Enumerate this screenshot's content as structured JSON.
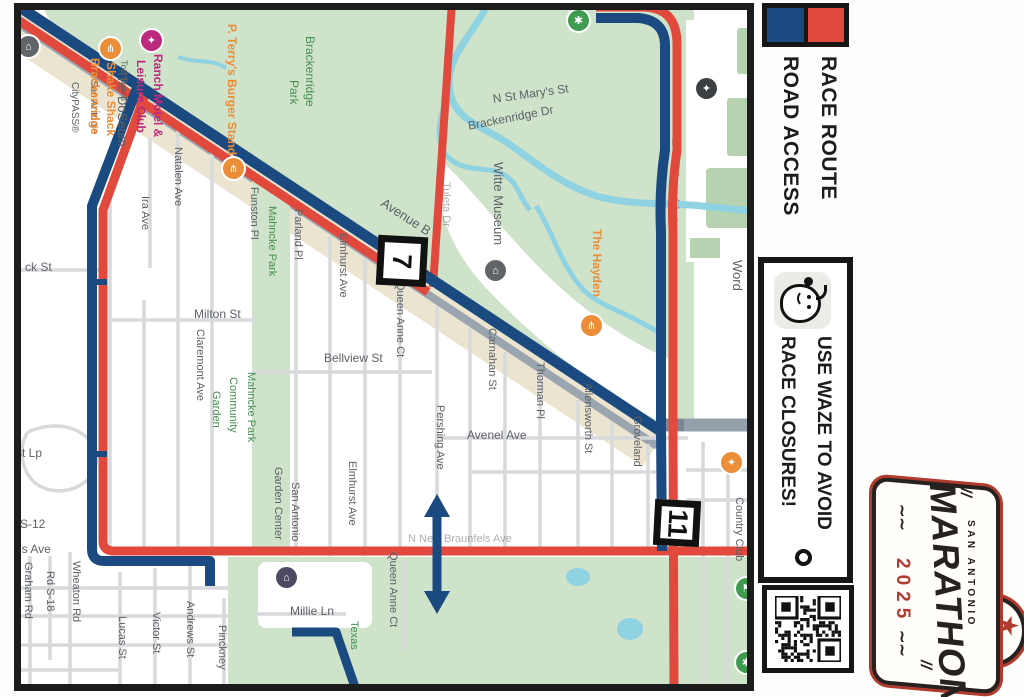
{
  "legend": {
    "race_route_label": "RACE ROUTE",
    "road_access_label": "ROAD ACCESS",
    "route_color": "#1b4a80",
    "access_color": "#e1493d"
  },
  "waze": {
    "line1": "USE WAZE TO AVOID",
    "line2": "RACE CLOSURES!"
  },
  "logo": {
    "city": "SAN ANTONIO",
    "title": "MARATHON",
    "year": "2025"
  },
  "map": {
    "mile_markers": [
      {
        "label": "7",
        "x": 377,
        "y": 236,
        "size": 50
      },
      {
        "label": "11",
        "x": 654,
        "y": 500,
        "size": 46
      }
    ],
    "labels": [
      {
        "text": "The DoSeum",
        "x": 113,
        "y": 70,
        "o": "v",
        "c": "gray",
        "s": 13
      },
      {
        "text": "San Antonio",
        "x": 85,
        "y": 80,
        "o": "v",
        "c": "gray",
        "s": 10
      },
      {
        "text": "CityPASS®",
        "x": 66,
        "y": 82,
        "o": "v",
        "c": "gray",
        "s": 10
      },
      {
        "text": "Ranch Motel &",
        "x": 149,
        "y": 54,
        "o": "v",
        "c": "pink",
        "s": 12
      },
      {
        "text": "Leisure Club",
        "x": 132,
        "y": 60,
        "o": "v",
        "c": "pink",
        "s": 12
      },
      {
        "text": "Top Rated",
        "x": 116,
        "y": 60,
        "o": "v",
        "c": "gray",
        "s": 9
      },
      {
        "text": "Shake Shack",
        "x": 102,
        "y": 62,
        "o": "v",
        "c": "orange",
        "s": 12
      },
      {
        "text": "Brackenridge",
        "x": 86,
        "y": 58,
        "o": "v",
        "c": "orange",
        "s": 12
      },
      {
        "text": "P. Terry's Burger Stand",
        "x": 223,
        "y": 24,
        "o": "v",
        "c": "orange",
        "s": 12
      },
      {
        "text": "Brackenridge",
        "x": 301,
        "y": 36,
        "o": "v",
        "c": "green",
        "s": 12
      },
      {
        "text": "Park",
        "x": 285,
        "y": 80,
        "o": "v",
        "c": "green",
        "s": 12
      },
      {
        "text": "Natalen Ave",
        "x": 169,
        "y": 147,
        "o": "v",
        "c": "gray",
        "s": 11
      },
      {
        "text": "Ira Ave",
        "x": 136,
        "y": 196,
        "o": "v",
        "c": "gray",
        "s": 11
      },
      {
        "text": "Funston Pl",
        "x": 245,
        "y": 187,
        "o": "v",
        "c": "gray",
        "s": 11
      },
      {
        "text": "Mahncke Park",
        "x": 263,
        "y": 206,
        "o": "v",
        "c": "green",
        "s": 11
      },
      {
        "text": "Parland Pl",
        "x": 289,
        "y": 209,
        "o": "v",
        "c": "gray",
        "s": 11
      },
      {
        "text": "Elmhurst Ave",
        "x": 334,
        "y": 233,
        "o": "v",
        "c": "gray",
        "s": 11
      },
      {
        "text": "Avenue B",
        "x": 386,
        "y": 196,
        "o": "d",
        "c": "gray",
        "s": 13,
        "rot": 33
      },
      {
        "text": "N St Mary's St",
        "x": 492,
        "y": 93,
        "o": "d",
        "c": "gray",
        "s": 12,
        "rot": -8
      },
      {
        "text": "Brackenridge Dr",
        "x": 467,
        "y": 120,
        "o": "d",
        "c": "gray",
        "s": 12,
        "rot": -11
      },
      {
        "text": "Witte Museum",
        "x": 489,
        "y": 162,
        "o": "v",
        "c": "gray",
        "s": 13
      },
      {
        "text": "The Hayden",
        "x": 588,
        "y": 229,
        "o": "v",
        "c": "orange",
        "s": 12
      },
      {
        "text": "the Incarnate",
        "x": 745,
        "y": 213,
        "o": "v",
        "c": "gray",
        "s": 13
      },
      {
        "text": "Word",
        "x": 728,
        "y": 260,
        "o": "v",
        "c": "gray",
        "s": 13
      },
      {
        "text": "Queen Anne Ct",
        "x": 391,
        "y": 282,
        "o": "v",
        "c": "gray",
        "s": 11
      },
      {
        "text": "Carnahan St",
        "x": 483,
        "y": 328,
        "o": "v",
        "c": "gray",
        "s": 11
      },
      {
        "text": "Thorman Pl",
        "x": 531,
        "y": 362,
        "o": "v",
        "c": "gray",
        "s": 11
      },
      {
        "text": "Allensworth St",
        "x": 579,
        "y": 383,
        "o": "v",
        "c": "gray",
        "s": 11
      },
      {
        "text": "Groveland",
        "x": 628,
        "y": 416,
        "o": "v",
        "c": "gray",
        "s": 11
      },
      {
        "text": "Milton St",
        "x": 194,
        "y": 308,
        "o": "h",
        "c": "gray",
        "s": 12
      },
      {
        "text": "Claremont Ave",
        "x": 191,
        "y": 329,
        "o": "v",
        "c": "gray",
        "s": 11
      },
      {
        "text": "Bellview St",
        "x": 324,
        "y": 352,
        "o": "h",
        "c": "gray",
        "s": 12
      },
      {
        "text": "Mahncke Park",
        "x": 242,
        "y": 372,
        "o": "v",
        "c": "green",
        "s": 11
      },
      {
        "text": "Community",
        "x": 224,
        "y": 377,
        "o": "v",
        "c": "green",
        "s": 11
      },
      {
        "text": "Garden",
        "x": 207,
        "y": 391,
        "o": "v",
        "c": "green",
        "s": 11
      },
      {
        "text": "Avenel Ave",
        "x": 467,
        "y": 429,
        "o": "h",
        "c": "gray",
        "s": 12
      },
      {
        "text": "Pershing Ave",
        "x": 431,
        "y": 405,
        "o": "v",
        "c": "gray",
        "s": 11
      },
      {
        "text": "San Antonio",
        "x": 286,
        "y": 482,
        "o": "v",
        "c": "gray",
        "s": 11
      },
      {
        "text": "Garden Center",
        "x": 269,
        "y": 467,
        "o": "v",
        "c": "gray",
        "s": 11
      },
      {
        "text": "San Antonio",
        "x": 747,
        "y": 494,
        "o": "v",
        "c": "gray",
        "s": 11
      },
      {
        "text": "Country Club",
        "x": 730,
        "y": 497,
        "o": "v",
        "c": "gray",
        "s": 11
      },
      {
        "text": "ck St",
        "x": 25,
        "y": 261,
        "o": "h",
        "c": "gray",
        "s": 12
      },
      {
        "text": "st Lp",
        "x": 16,
        "y": 447,
        "o": "h",
        "c": "gray",
        "s": 12
      },
      {
        "text": "d S-12",
        "x": 10,
        "y": 518,
        "o": "h",
        "c": "gray",
        "s": 12
      },
      {
        "text": "fels Ave",
        "x": 9,
        "y": 543,
        "o": "h",
        "c": "gray",
        "s": 12
      },
      {
        "text": "Graham Rd",
        "x": 19,
        "y": 562,
        "o": "v",
        "c": "gray",
        "s": 11
      },
      {
        "text": "Rd S-18",
        "x": 41,
        "y": 571,
        "o": "v",
        "c": "gray",
        "s": 11
      },
      {
        "text": "Wheaton Rd",
        "x": 67,
        "y": 561,
        "o": "v",
        "c": "gray",
        "s": 11
      },
      {
        "text": "Lucas St",
        "x": 113,
        "y": 616,
        "o": "v",
        "c": "gray",
        "s": 11
      },
      {
        "text": "Victor St",
        "x": 147,
        "y": 612,
        "o": "v",
        "c": "gray",
        "s": 11
      },
      {
        "text": "Andrews St",
        "x": 181,
        "y": 601,
        "o": "v",
        "c": "gray",
        "s": 11
      },
      {
        "text": "Pinckney",
        "x": 213,
        "y": 625,
        "o": "v",
        "c": "gray",
        "s": 11
      },
      {
        "text": "Millie Ln",
        "x": 290,
        "y": 605,
        "o": "h",
        "c": "gray",
        "s": 12
      },
      {
        "text": "Texas",
        "x": 345,
        "y": 621,
        "o": "v",
        "c": "green",
        "s": 11
      },
      {
        "text": "Queen Anne Ct",
        "x": 384,
        "y": 552,
        "o": "v",
        "c": "gray",
        "s": 11
      },
      {
        "text": "Elmhurst Ave",
        "x": 343,
        "y": 461,
        "o": "v",
        "c": "gray",
        "s": 11
      },
      {
        "text": "Tuleta Dr",
        "x": 437,
        "y": 182,
        "o": "v",
        "c": "gray",
        "s": 11,
        "under": true
      },
      {
        "text": "E Hildebrand Ave",
        "x": 666,
        "y": 138,
        "o": "v",
        "c": "gray",
        "s": 11,
        "under": true
      },
      {
        "text": "N New Braunfels Ave",
        "x": 408,
        "y": 534,
        "o": "h",
        "c": "gray",
        "s": 11,
        "under": true
      }
    ],
    "pois": [
      {
        "name": "doseum-museum-icon",
        "x": 28,
        "y": 46,
        "color": "#606569",
        "glyph": "⌂"
      },
      {
        "name": "shake-shack-restaurant-icon",
        "x": 110,
        "y": 48,
        "color": "#ec8d38",
        "glyph": "⋔"
      },
      {
        "name": "ranch-motel-icon",
        "x": 151,
        "y": 40,
        "color": "#bb2a7c",
        "glyph": "✦"
      },
      {
        "name": "p-terrys-restaurant-icon",
        "x": 233,
        "y": 168,
        "color": "#ec8d38",
        "glyph": "⋔"
      },
      {
        "name": "park-paw-icon",
        "x": 578,
        "y": 20,
        "color": "#3e9b4f",
        "glyph": "✱"
      },
      {
        "name": "witte-museum-icon",
        "x": 495,
        "y": 270,
        "color": "#606569",
        "glyph": "⌂"
      },
      {
        "name": "hayden-restaurant-icon",
        "x": 591,
        "y": 325,
        "color": "#ec8d38",
        "glyph": "⋔"
      },
      {
        "name": "incarnate-word-school-icon",
        "x": 706,
        "y": 88,
        "color": "#3c4043",
        "glyph": "✦"
      },
      {
        "name": "shopping-icon",
        "x": 731,
        "y": 462,
        "color": "#ec8d38",
        "glyph": "✦"
      },
      {
        "name": "golf-flag-icon",
        "x": 746,
        "y": 588,
        "color": "#3e9b4f",
        "glyph": "⚑"
      },
      {
        "name": "park-icon",
        "x": 746,
        "y": 662,
        "color": "#3e9b4f",
        "glyph": "✱"
      },
      {
        "name": "garden-center-museum-icon",
        "x": 286,
        "y": 577,
        "color": "#4f4a63",
        "glyph": "⌂"
      }
    ]
  }
}
